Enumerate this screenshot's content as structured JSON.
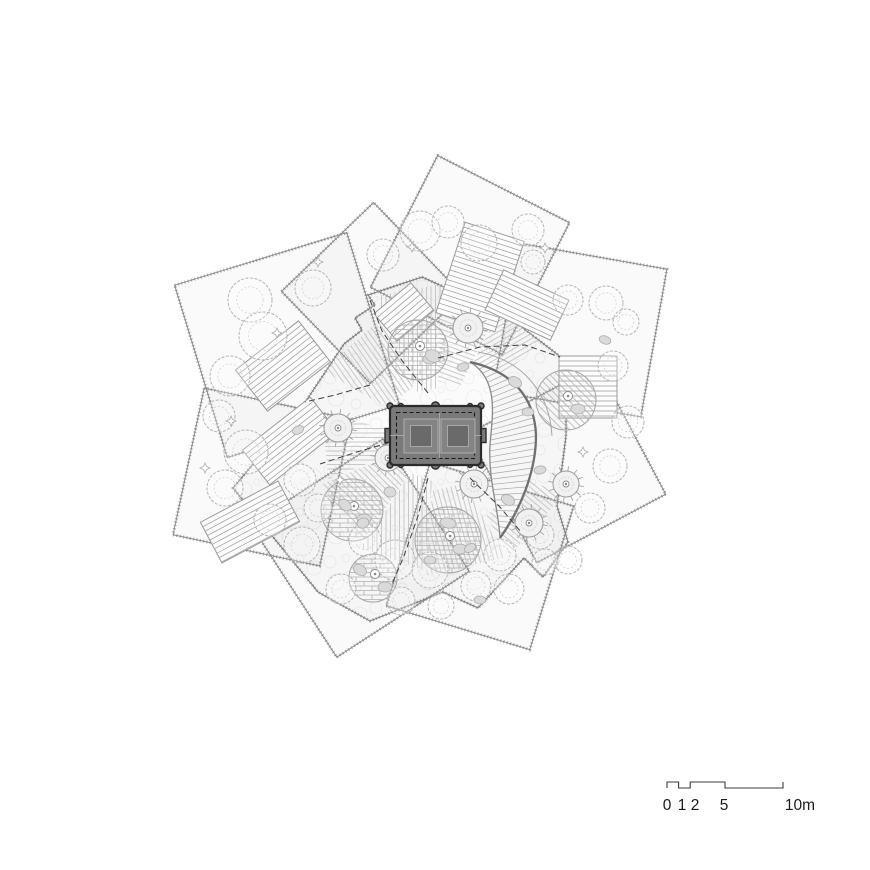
{
  "title": "rooftop-garden-site-plan",
  "colors": {
    "background": "#ffffff",
    "petal_fill": "rgba(0,0,0,0.018)",
    "plaza_fill": "#fbfbfb",
    "stipple": "#ababab",
    "edge": "#858585",
    "plaza_edge": "#7d7d7d",
    "hatch": "#bcbcbc",
    "stair_line": "#9a9a9a",
    "stair_fill": "#fcfcfc",
    "fan_fill": "#f6f6f6",
    "fan_edge_outer": "#6f6f6f",
    "fan_edge_inner": "#8a8a8a",
    "fan_line": "#a8a8a8",
    "terrace_stroke": "#a5a5a5",
    "tree_canopy": "#b4b4b4",
    "tree_inner": "#d2d2d2",
    "planter_stroke": "#9a9a9a",
    "planter_center": "#8a8a8a",
    "blob_fill": "#dadada",
    "blob_stroke": "#adadad",
    "sparkle": "#aaaaaa",
    "path_dash": "#3f3f3f",
    "pebble": "#ececec",
    "brick": "#b0b0b0",
    "pavilion_fill": "#7a7a7a",
    "pavilion_stroke": "#2b2b2b",
    "pavilion_mid": "#848484",
    "pavilion_dark": "#6a6a6a",
    "pavilion_light_line": "#b3b3b3",
    "pavilion_dash": "#1a1a1a",
    "scale_line": "#3d3d3d",
    "text": "#1b1b1b"
  },
  "plan": {
    "center": {
      "x": 436,
      "y": 436
    },
    "petals": [
      {
        "cx": 287,
        "cy": 345,
        "size": 180,
        "rot": -17
      },
      {
        "cx": 262,
        "cy": 477,
        "size": 150,
        "rot": 12
      },
      {
        "cx": 360,
        "cy": 548,
        "size": 158,
        "rot": -33
      },
      {
        "cx": 480,
        "cy": 556,
        "size": 150,
        "rot": 17
      },
      {
        "cx": 567,
        "cy": 464,
        "size": 146,
        "rot": -28
      },
      {
        "cx": 580,
        "cy": 330,
        "size": 150,
        "rot": 10
      },
      {
        "cx": 470,
        "cy": 255,
        "size": 148,
        "rot": 27
      },
      {
        "cx": 372,
        "cy": 293,
        "size": 128,
        "rot": -44
      }
    ],
    "plaza": {
      "points": [
        [
          422,
          277
        ],
        [
          506,
          315
        ],
        [
          566,
          361
        ],
        [
          566,
          436
        ],
        [
          557,
          506
        ],
        [
          568,
          542
        ],
        [
          543,
          577
        ],
        [
          524,
          558
        ],
        [
          478,
          608
        ],
        [
          443,
          592
        ],
        [
          370,
          621
        ],
        [
          318,
          592
        ],
        [
          233,
          488
        ],
        [
          306,
          401
        ],
        [
          344,
          344
        ],
        [
          362,
          330
        ],
        [
          355,
          318
        ],
        [
          375,
          305
        ],
        [
          368,
          295
        ]
      ]
    },
    "wedges": [
      {
        "a1": -150,
        "a2": -115,
        "r1": 55,
        "r2": 130,
        "hatch": 55
      },
      {
        "a1": -113,
        "a2": -88,
        "r1": 48,
        "r2": 152,
        "hatch": 90
      },
      {
        "a1": -88,
        "a2": -64,
        "r1": 55,
        "r2": 150,
        "hatch": 20
      },
      {
        "a1": -63,
        "a2": -42,
        "r1": 82,
        "r2": 142,
        "hatch": -30
      },
      {
        "a1": 25,
        "a2": 58,
        "r1": 95,
        "r2": 140,
        "hatch": 40
      },
      {
        "a1": 60,
        "a2": 94,
        "r1": 55,
        "r2": 140,
        "hatch": 75
      },
      {
        "a1": 95,
        "a2": 124,
        "r1": 45,
        "r2": 135,
        "hatch": 90
      },
      {
        "a1": 125,
        "a2": 157,
        "r1": 48,
        "r2": 126,
        "hatch": 45
      },
      {
        "a1": 158,
        "a2": 190,
        "r1": 50,
        "r2": 116,
        "hatch": 0
      }
    ],
    "stairs": [
      {
        "cx": 480,
        "cy": 277,
        "w": 62,
        "h": 95,
        "rot": 18
      },
      {
        "cx": 283,
        "cy": 366,
        "w": 80,
        "h": 52,
        "rot": -38
      },
      {
        "cx": 290,
        "cy": 441,
        "w": 86,
        "h": 44,
        "rot": -38
      },
      {
        "cx": 250,
        "cy": 522,
        "w": 88,
        "h": 46,
        "rot": -28
      },
      {
        "cx": 527,
        "cy": 305,
        "w": 72,
        "h": 44,
        "rot": 25
      },
      {
        "cx": 588,
        "cy": 387,
        "w": 58,
        "h": 62,
        "rot": 0
      },
      {
        "cx": 404,
        "cy": 312,
        "w": 48,
        "h": 36,
        "rot": -40
      }
    ],
    "fan": {
      "inner": [
        [
          [
            470,
            362
          ],
          [
            500,
            380
          ],
          [
            492,
            418
          ],
          [
            490,
            445
          ]
        ],
        [
          [
            490,
            445
          ],
          [
            488,
            480
          ],
          [
            498,
            505
          ],
          [
            500,
            538
          ]
        ]
      ],
      "outer": [
        [
          [
            470,
            362
          ],
          [
            515,
            372
          ],
          [
            535,
            400
          ],
          [
            536,
            436
          ]
        ],
        [
          [
            536,
            436
          ],
          [
            536,
            472
          ],
          [
            520,
            510
          ],
          [
            500,
            538
          ]
        ]
      ],
      "extra_arc": [
        [
          478,
          352
        ],
        [
          525,
          360
        ],
        [
          550,
          396
        ],
        [
          552,
          436
        ]
      ],
      "lines": 34
    },
    "terraces": [
      {
        "cx": 418,
        "cy": 350,
        "r": 30,
        "style": "brick"
      },
      {
        "cx": 352,
        "cy": 510,
        "r": 31,
        "style": "brick"
      },
      {
        "cx": 448,
        "cy": 540,
        "r": 33,
        "style": "brick"
      },
      {
        "cx": 566,
        "cy": 400,
        "r": 30,
        "style": "diag"
      },
      {
        "cx": 373,
        "cy": 578,
        "r": 24,
        "style": "brick"
      }
    ],
    "planter_trees": [
      {
        "cx": 468,
        "cy": 328,
        "r": 15
      },
      {
        "cx": 338,
        "cy": 428,
        "r": 14
      },
      {
        "cx": 388,
        "cy": 458,
        "r": 13
      },
      {
        "cx": 474,
        "cy": 484,
        "r": 14
      },
      {
        "cx": 566,
        "cy": 484,
        "r": 13
      },
      {
        "cx": 529,
        "cy": 523,
        "r": 14
      }
    ],
    "canopy_trees": [
      {
        "cx": 250,
        "cy": 300,
        "r": 22
      },
      {
        "cx": 263,
        "cy": 336,
        "r": 24
      },
      {
        "cx": 313,
        "cy": 288,
        "r": 18
      },
      {
        "cx": 230,
        "cy": 376,
        "r": 20
      },
      {
        "cx": 219,
        "cy": 416,
        "r": 16
      },
      {
        "cx": 246,
        "cy": 452,
        "r": 22
      },
      {
        "cx": 225,
        "cy": 488,
        "r": 18
      },
      {
        "cx": 420,
        "cy": 231,
        "r": 20
      },
      {
        "cx": 448,
        "cy": 222,
        "r": 16
      },
      {
        "cx": 479,
        "cy": 243,
        "r": 18
      },
      {
        "cx": 383,
        "cy": 255,
        "r": 16
      },
      {
        "cx": 528,
        "cy": 230,
        "r": 16
      },
      {
        "cx": 533,
        "cy": 262,
        "r": 12
      },
      {
        "cx": 568,
        "cy": 300,
        "r": 15
      },
      {
        "cx": 606,
        "cy": 303,
        "r": 17
      },
      {
        "cx": 626,
        "cy": 322,
        "r": 13
      },
      {
        "cx": 613,
        "cy": 366,
        "r": 15
      },
      {
        "cx": 628,
        "cy": 422,
        "r": 16
      },
      {
        "cx": 610,
        "cy": 466,
        "r": 17
      },
      {
        "cx": 590,
        "cy": 508,
        "r": 15
      },
      {
        "cx": 568,
        "cy": 560,
        "r": 14
      },
      {
        "cx": 545,
        "cy": 562,
        "r": 13
      },
      {
        "cx": 509,
        "cy": 589,
        "r": 15
      },
      {
        "cx": 476,
        "cy": 586,
        "r": 15
      },
      {
        "cx": 441,
        "cy": 606,
        "r": 13
      },
      {
        "cx": 401,
        "cy": 601,
        "r": 14
      },
      {
        "cx": 341,
        "cy": 589,
        "r": 15
      },
      {
        "cx": 302,
        "cy": 545,
        "r": 18
      },
      {
        "cx": 270,
        "cy": 520,
        "r": 16
      },
      {
        "cx": 300,
        "cy": 480,
        "r": 16
      },
      {
        "cx": 318,
        "cy": 508,
        "r": 14
      },
      {
        "cx": 395,
        "cy": 560,
        "r": 20
      },
      {
        "cx": 430,
        "cy": 570,
        "r": 18
      },
      {
        "cx": 500,
        "cy": 555,
        "r": 16
      },
      {
        "cx": 540,
        "cy": 535,
        "r": 14
      },
      {
        "cx": 365,
        "cy": 540,
        "r": 16
      }
    ],
    "blobs": [
      {
        "cx": 433,
        "cy": 356,
        "rx": 8,
        "ry": 6,
        "rot": 20
      },
      {
        "cx": 463,
        "cy": 367,
        "rx": 6,
        "ry": 4,
        "rot": -15
      },
      {
        "cx": 515,
        "cy": 382,
        "rx": 7,
        "ry": 5,
        "rot": 30
      },
      {
        "cx": 528,
        "cy": 412,
        "rx": 6,
        "ry": 4,
        "rot": 0
      },
      {
        "cx": 345,
        "cy": 505,
        "rx": 7,
        "ry": 5,
        "rot": 40
      },
      {
        "cx": 363,
        "cy": 523,
        "rx": 6,
        "ry": 5,
        "rot": -20
      },
      {
        "cx": 448,
        "cy": 523,
        "rx": 8,
        "ry": 5,
        "rot": 10
      },
      {
        "cx": 470,
        "cy": 548,
        "rx": 6,
        "ry": 4,
        "rot": -30
      },
      {
        "cx": 508,
        "cy": 500,
        "rx": 7,
        "ry": 5,
        "rot": 25
      },
      {
        "cx": 430,
        "cy": 560,
        "rx": 6,
        "ry": 4,
        "rot": 0
      },
      {
        "cx": 390,
        "cy": 492,
        "rx": 6,
        "ry": 5,
        "rot": 15
      },
      {
        "cx": 540,
        "cy": 470,
        "rx": 6,
        "ry": 4,
        "rot": -10
      },
      {
        "cx": 605,
        "cy": 340,
        "rx": 6,
        "ry": 4,
        "rot": 20
      },
      {
        "cx": 298,
        "cy": 430,
        "rx": 6,
        "ry": 4,
        "rot": -25
      },
      {
        "cx": 360,
        "cy": 570,
        "rx": 7,
        "ry": 5,
        "rot": 35
      },
      {
        "cx": 480,
        "cy": 600,
        "rx": 6,
        "ry": 4,
        "rot": 0
      }
    ],
    "sparkles": [
      {
        "x": 277,
        "y": 333
      },
      {
        "x": 231,
        "y": 421
      },
      {
        "x": 318,
        "y": 262
      },
      {
        "x": 205,
        "y": 468
      },
      {
        "x": 545,
        "y": 248
      },
      {
        "x": 583,
        "y": 452
      },
      {
        "x": 412,
        "y": 247
      },
      {
        "x": 340,
        "y": 480
      }
    ],
    "paths": [
      {
        "points": [
          [
            428,
            393
          ],
          [
            403,
            362
          ],
          [
            382,
            331
          ],
          [
            370,
            300
          ]
        ]
      },
      {
        "points": [
          [
            438,
            358
          ],
          [
            480,
            347
          ],
          [
            525,
            345
          ],
          [
            560,
            357
          ]
        ]
      },
      {
        "points": [
          [
            398,
            440
          ],
          [
            357,
            452
          ],
          [
            320,
            464
          ]
        ]
      },
      {
        "points": [
          [
            428,
            478
          ],
          [
            418,
            516
          ],
          [
            404,
            556
          ],
          [
            392,
            584
          ]
        ]
      },
      {
        "points": [
          [
            470,
            478
          ],
          [
            499,
            506
          ],
          [
            521,
            532
          ]
        ]
      },
      {
        "points": [
          [
            370,
            385
          ],
          [
            335,
            395
          ],
          [
            305,
            402
          ]
        ]
      }
    ],
    "pavilion": {
      "x": 390,
      "y": 406,
      "w": 91,
      "h": 59,
      "rx": 4,
      "dash_inset": 6.5,
      "squares": [
        {
          "x": 404,
          "y": 419,
          "s": 34
        },
        {
          "x": 441,
          "y": 419,
          "s": 34
        }
      ],
      "square_inset": 6.5,
      "bump_fracs": [
        0.12,
        0.5,
        0.88
      ],
      "bump_r_small": 2.5,
      "bump_r_big": 4,
      "tab": {
        "w": 5,
        "h": 14
      },
      "knob_r": 3
    }
  },
  "scale_bar": {
    "x0": 667,
    "px_per_m": 11.6,
    "y_high": 782,
    "y_low": 788,
    "marks": [
      0,
      1,
      2,
      5,
      10
    ],
    "labels": [
      {
        "text": "0",
        "x": 667
      },
      {
        "text": "1",
        "x": 682
      },
      {
        "text": "2",
        "x": 695
      },
      {
        "text": "5",
        "x": 724
      },
      {
        "text": "10m",
        "x": 800
      }
    ],
    "label_y": 810,
    "font_size": 15.5
  }
}
